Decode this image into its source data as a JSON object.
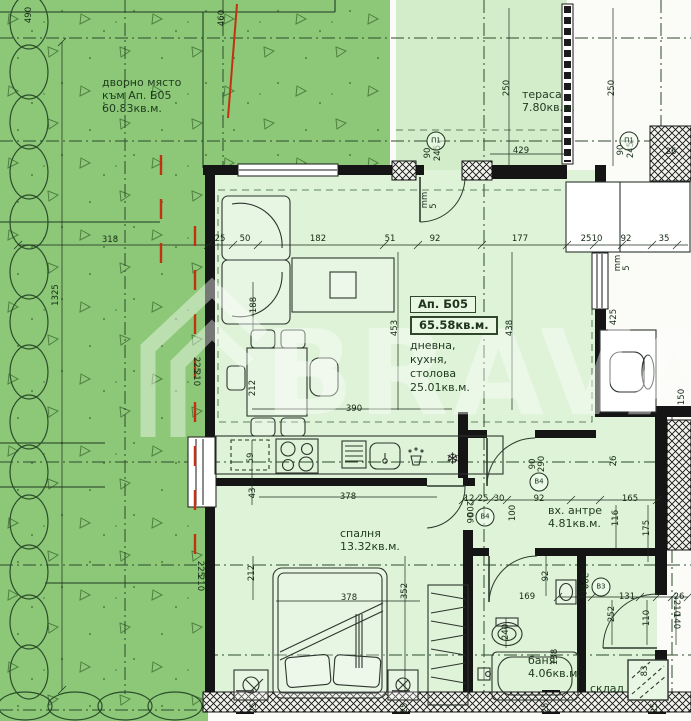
{
  "colors": {
    "yard_green": "#8cc878",
    "interior_green": "#def3d8",
    "terrace_green": "#d3edcb",
    "line_dark": "#1c2b1c",
    "red_marker": "#c23210",
    "watermark_white": "#ffffff"
  },
  "yard": {
    "line1": "дворно място",
    "line2": "към Ап. Б05",
    "area": "60.83кв.м."
  },
  "apartment": {
    "id": "Ап. Б05",
    "total_area": "65.58кв.м."
  },
  "rooms": {
    "terrace": {
      "label": "тераса",
      "area": "7.80кв.м."
    },
    "living": {
      "line1": "дневна,",
      "line2": "кухня,",
      "line3": "столова",
      "area": "25.01кв.м."
    },
    "bedroom": {
      "label": "спалня",
      "area": "13.32кв.м."
    },
    "hall": {
      "label": "вх. антре",
      "area": "4.81кв.м."
    },
    "bath": {
      "label": "баня",
      "area": "4.06кв.м."
    },
    "storage": {
      "label": "склад"
    }
  },
  "watermark": {
    "text": "BRAVA"
  },
  "markers": [
    {
      "t": "П1",
      "x": 436,
      "y": 141
    },
    {
      "t": "П1",
      "x": 629,
      "y": 141
    },
    {
      "t": "В4",
      "x": 539,
      "y": 482
    },
    {
      "t": "В4",
      "x": 485,
      "y": 517
    },
    {
      "t": "В3",
      "x": 601,
      "y": 587
    }
  ],
  "dimensions": [
    {
      "t": "490",
      "x": 29,
      "y": 15,
      "r": -90
    },
    {
      "t": "460",
      "x": 222,
      "y": 18,
      "r": -90
    },
    {
      "t": "318",
      "x": 110,
      "y": 240,
      "r": 0
    },
    {
      "t": "1325",
      "x": 56,
      "y": 295,
      "r": -90
    },
    {
      "t": "25",
      "x": 220,
      "y": 239,
      "r": 0
    },
    {
      "t": "50",
      "x": 245,
      "y": 239,
      "r": 0
    },
    {
      "t": "182",
      "x": 318,
      "y": 239,
      "r": 0
    },
    {
      "t": "51",
      "x": 390,
      "y": 239,
      "r": 0
    },
    {
      "t": "92",
      "x": 435,
      "y": 239,
      "r": 0
    },
    {
      "t": "177",
      "x": 520,
      "y": 239,
      "r": 0
    },
    {
      "t": "25",
      "x": 586,
      "y": 239,
      "r": 0
    },
    {
      "t": "10",
      "x": 597,
      "y": 239,
      "r": 0
    },
    {
      "t": "92",
      "x": 626,
      "y": 239,
      "r": 0
    },
    {
      "t": "35",
      "x": 664,
      "y": 239,
      "r": 0
    },
    {
      "t": "250",
      "x": 507,
      "y": 88,
      "r": -90
    },
    {
      "t": "429",
      "x": 521,
      "y": 151,
      "r": 0
    },
    {
      "t": "250",
      "x": 612,
      "y": 88,
      "r": -90
    },
    {
      "t": "90",
      "x": 621,
      "y": 150,
      "r": -90
    },
    {
      "t": "245",
      "x": 631,
      "y": 150,
      "r": -90
    },
    {
      "t": "90",
      "x": 428,
      "y": 153,
      "r": -90
    },
    {
      "t": "245",
      "x": 438,
      "y": 153,
      "r": -90
    },
    {
      "t": "26",
      "x": 671,
      "y": 152,
      "r": 0
    },
    {
      "t": "mm",
      "x": 425,
      "y": 200,
      "r": -90
    },
    {
      "t": "5",
      "x": 434,
      "y": 206,
      "r": -90
    },
    {
      "t": "mm",
      "x": 618,
      "y": 263,
      "r": -90
    },
    {
      "t": "5",
      "x": 627,
      "y": 268,
      "r": -90
    },
    {
      "t": "453",
      "x": 395,
      "y": 328,
      "r": -90
    },
    {
      "t": "438",
      "x": 510,
      "y": 328,
      "r": -90
    },
    {
      "t": "425",
      "x": 614,
      "y": 317,
      "r": -90
    },
    {
      "t": "150",
      "x": 682,
      "y": 397,
      "r": -90
    },
    {
      "t": "188",
      "x": 254,
      "y": 305,
      "r": -90
    },
    {
      "t": "225",
      "x": 196,
      "y": 365,
      "r": 90
    },
    {
      "t": "210",
      "x": 196,
      "y": 378,
      "r": 90
    },
    {
      "t": "212",
      "x": 253,
      "y": 388,
      "r": -90
    },
    {
      "t": "390",
      "x": 354,
      "y": 409,
      "r": 0
    },
    {
      "t": "59",
      "x": 251,
      "y": 458,
      "r": -90
    },
    {
      "t": "26",
      "x": 614,
      "y": 461,
      "r": -90
    },
    {
      "t": "90",
      "x": 533,
      "y": 464,
      "r": -90
    },
    {
      "t": "290",
      "x": 542,
      "y": 464,
      "r": -90
    },
    {
      "t": "43",
      "x": 253,
      "y": 493,
      "r": -90
    },
    {
      "t": "378",
      "x": 348,
      "y": 497,
      "r": 0
    },
    {
      "t": "12",
      "x": 469,
      "y": 499,
      "r": 0
    },
    {
      "t": "25",
      "x": 483,
      "y": 499,
      "r": 0
    },
    {
      "t": "30",
      "x": 499,
      "y": 499,
      "r": 0
    },
    {
      "t": "92",
      "x": 539,
      "y": 499,
      "r": 0
    },
    {
      "t": "165",
      "x": 630,
      "y": 499,
      "r": 0
    },
    {
      "t": "100",
      "x": 513,
      "y": 513,
      "r": -90
    },
    {
      "t": "200",
      "x": 469,
      "y": 509,
      "r": 90
    },
    {
      "t": "06",
      "x": 469,
      "y": 518,
      "r": 90
    },
    {
      "t": "116",
      "x": 616,
      "y": 518,
      "r": -90
    },
    {
      "t": "175",
      "x": 647,
      "y": 528,
      "r": -90
    },
    {
      "t": "225",
      "x": 200,
      "y": 569,
      "r": 90
    },
    {
      "t": "210",
      "x": 200,
      "y": 583,
      "r": 90
    },
    {
      "t": "212",
      "x": 252,
      "y": 573,
      "r": -90
    },
    {
      "t": "378",
      "x": 349,
      "y": 598,
      "r": 0
    },
    {
      "t": "352",
      "x": 405,
      "y": 591,
      "r": -90
    },
    {
      "t": "92",
      "x": 546,
      "y": 576,
      "r": -90
    },
    {
      "t": "169",
      "x": 527,
      "y": 597,
      "r": 0
    },
    {
      "t": "200",
      "x": 584,
      "y": 581,
      "r": 90
    },
    {
      "t": "06",
      "x": 582,
      "y": 590,
      "r": 90
    },
    {
      "t": "131",
      "x": 627,
      "y": 597,
      "r": 0
    },
    {
      "t": "26",
      "x": 679,
      "y": 597,
      "r": 0
    },
    {
      "t": "252",
      "x": 612,
      "y": 614,
      "r": -90
    },
    {
      "t": "110",
      "x": 647,
      "y": 618,
      "r": -90
    },
    {
      "t": "210",
      "x": 676,
      "y": 608,
      "r": 90
    },
    {
      "t": "140",
      "x": 676,
      "y": 621,
      "r": 90
    },
    {
      "t": "240",
      "x": 506,
      "y": 632,
      "r": -90
    },
    {
      "t": "138",
      "x": 555,
      "y": 657,
      "r": -90
    },
    {
      "t": "83",
      "x": 645,
      "y": 671,
      "r": -90
    },
    {
      "t": "25",
      "x": 254,
      "y": 708,
      "r": -90
    },
    {
      "t": "25",
      "x": 405,
      "y": 708,
      "r": -90
    },
    {
      "t": "25",
      "x": 546,
      "y": 708,
      "r": -90
    },
    {
      "t": "25",
      "x": 655,
      "y": 708,
      "r": -90
    }
  ]
}
